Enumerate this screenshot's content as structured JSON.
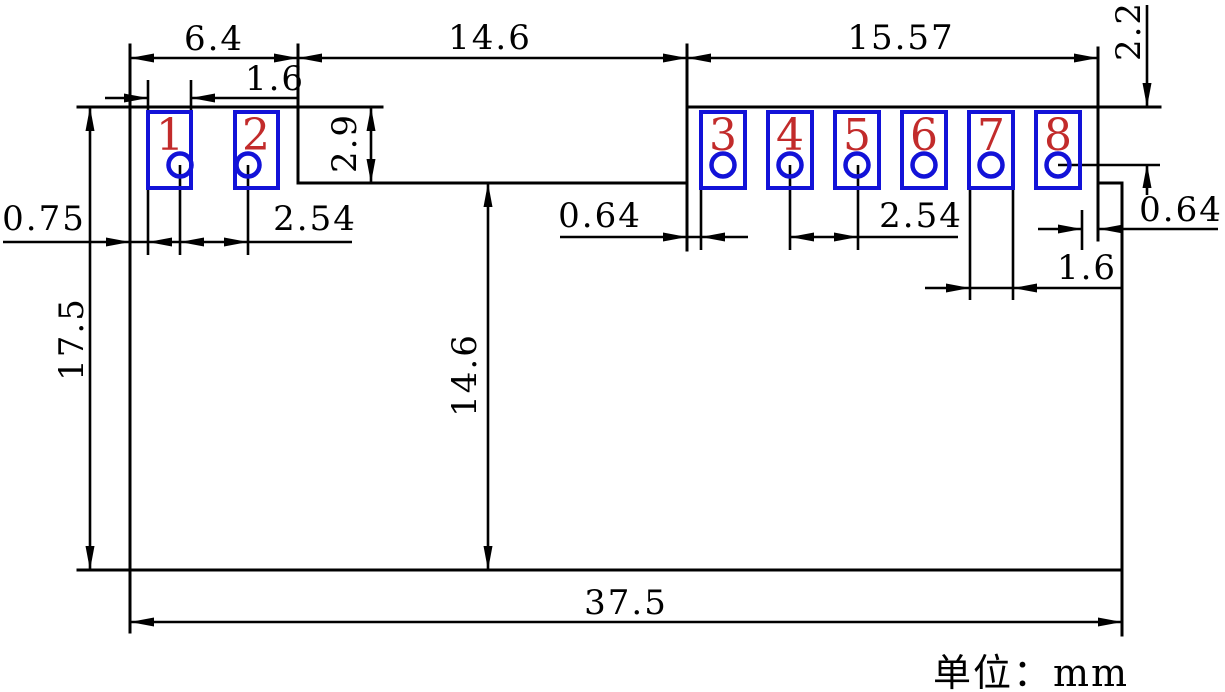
{
  "drawing": {
    "unit_note": "单位：mm",
    "pads": [
      {
        "number": "1"
      },
      {
        "number": "2"
      },
      {
        "number": "3"
      },
      {
        "number": "4"
      },
      {
        "number": "5"
      },
      {
        "number": "6"
      },
      {
        "number": "7"
      },
      {
        "number": "8"
      }
    ],
    "dimensions": {
      "pads12_span": "6.4",
      "pad1_width": "1.6",
      "notch_width": "14.6",
      "pads38_span": "15.57",
      "pin8_hole_from_top": "2.2",
      "left_edge_to_pad1": "0.75",
      "holes12_pitch": "2.54",
      "notch_depth": "2.9",
      "notch_to_pad3_gap": "0.64",
      "holes45_pitch": "2.54",
      "pad8_to_right_edge": "0.64",
      "pad7_width": "1.6",
      "body_height": "17.5",
      "notch_to_bottom": "14.6",
      "total_width": "37.5"
    },
    "colors": {
      "line": "#000000",
      "pad_outline": "#1212d8",
      "pin_number": "#c22b2b",
      "background": "#ffffff"
    }
  }
}
